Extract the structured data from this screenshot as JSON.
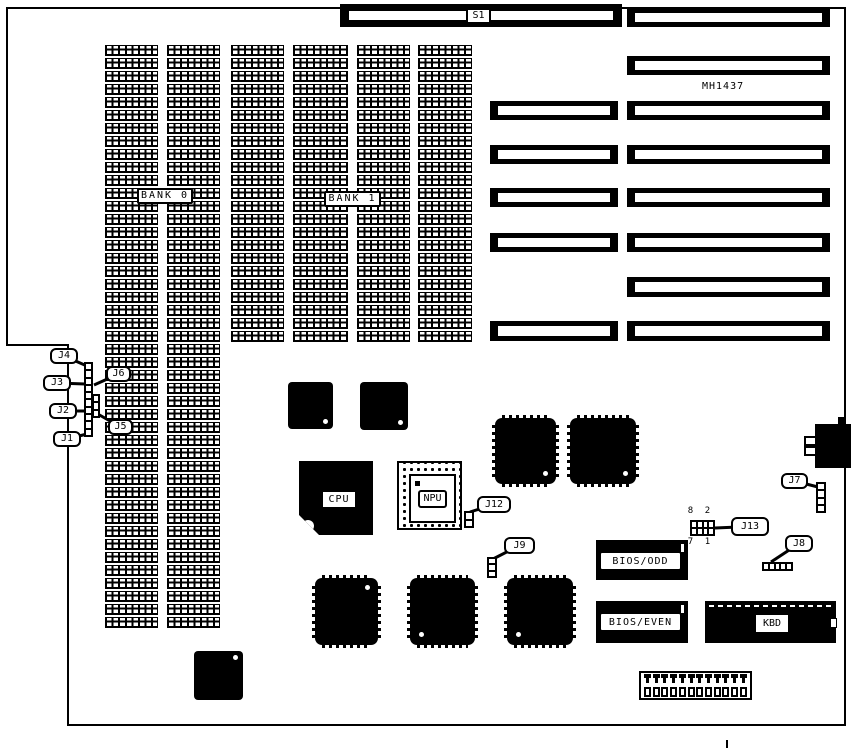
{
  "board": {
    "part_number": "MH1437",
    "outline_path": "M 7 8 H 845 V 725 H 68 V 345 H 7 Z",
    "ink_color": "#000000",
    "background_color": "#ffffff"
  },
  "labels": {
    "s1": "S1",
    "mh": "MH1437"
  },
  "j13_pins": {
    "tl": "8",
    "tr": "2",
    "bl": "7",
    "br": "1"
  },
  "slots": [
    {
      "x": 490,
      "y": 101,
      "w": 128,
      "h": 19
    },
    {
      "x": 490,
      "y": 145,
      "w": 128,
      "h": 19
    },
    {
      "x": 490,
      "y": 188,
      "w": 128,
      "h": 19
    },
    {
      "x": 490,
      "y": 233,
      "w": 128,
      "h": 19
    },
    {
      "x": 490,
      "y": 321,
      "w": 128,
      "h": 20
    },
    {
      "x": 627,
      "y": 8,
      "w": 203,
      "h": 19
    },
    {
      "x": 627,
      "y": 56,
      "w": 203,
      "h": 19
    },
    {
      "x": 627,
      "y": 101,
      "w": 203,
      "h": 19
    },
    {
      "x": 627,
      "y": 145,
      "w": 203,
      "h": 19
    },
    {
      "x": 627,
      "y": 188,
      "w": 203,
      "h": 19
    },
    {
      "x": 627,
      "y": 233,
      "w": 203,
      "h": 19
    },
    {
      "x": 627,
      "y": 277,
      "w": 203,
      "h": 20
    },
    {
      "x": 627,
      "y": 321,
      "w": 203,
      "h": 20
    }
  ],
  "memory": {
    "banks": [
      {
        "label": "BANK 0",
        "x": 137,
        "y": 188,
        "w": 56,
        "h": 16
      },
      {
        "label": "BANK 1",
        "x": 324,
        "y": 191,
        "w": 57,
        "h": 16
      }
    ],
    "columns": [
      {
        "x": 105,
        "y": 45,
        "w": 53,
        "chips": 45
      },
      {
        "x": 167,
        "y": 45,
        "w": 53,
        "chips": 45
      },
      {
        "x": 231,
        "y": 45,
        "w": 53,
        "chips": 23
      },
      {
        "x": 293,
        "y": 45,
        "w": 55,
        "chips": 23
      },
      {
        "x": 357,
        "y": 45,
        "w": 53,
        "chips": 23
      },
      {
        "x": 418,
        "y": 45,
        "w": 54,
        "chips": 23
      }
    ]
  },
  "chips": [
    {
      "name": "square-chip-1",
      "style": "plain",
      "x": 288,
      "y": 382,
      "w": 45,
      "h": 47,
      "dot": "br"
    },
    {
      "name": "square-chip-2",
      "style": "plain",
      "x": 360,
      "y": 382,
      "w": 48,
      "h": 48,
      "dot": "br"
    },
    {
      "name": "cpu",
      "style": "cpu",
      "x": 299,
      "y": 461,
      "w": 74,
      "h": 74,
      "label": "CPU"
    },
    {
      "name": "npu",
      "style": "pga",
      "x": 397,
      "y": 461,
      "w": 65,
      "h": 69,
      "label": "NPU"
    },
    {
      "name": "qfp-chip-1",
      "style": "qfp",
      "x": 495,
      "y": 418,
      "w": 61,
      "h": 66,
      "dot": "br"
    },
    {
      "name": "qfp-chip-2",
      "style": "qfp",
      "x": 570,
      "y": 418,
      "w": 66,
      "h": 66,
      "dot": "br"
    },
    {
      "name": "qfp-chip-3",
      "style": "qfp",
      "x": 315,
      "y": 578,
      "w": 63,
      "h": 67,
      "dot": "tr"
    },
    {
      "name": "qfp-chip-4",
      "style": "qfp",
      "x": 410,
      "y": 578,
      "w": 65,
      "h": 67,
      "dot": "bl"
    },
    {
      "name": "qfp-chip-5",
      "style": "qfp",
      "x": 507,
      "y": 578,
      "w": 66,
      "h": 67,
      "dot": "bl"
    },
    {
      "name": "square-chip-3",
      "style": "plain",
      "x": 194,
      "y": 651,
      "w": 49,
      "h": 49,
      "dot": "tr"
    },
    {
      "name": "bios-odd-rom",
      "style": "rom",
      "x": 596,
      "y": 540,
      "w": 92,
      "h": 40,
      "label": "BIOS/ODD"
    },
    {
      "name": "bios-even-rom",
      "style": "rom",
      "x": 596,
      "y": 601,
      "w": 92,
      "h": 42,
      "label": "BIOS/EVEN"
    },
    {
      "name": "kbd-controller",
      "style": "kbd",
      "x": 705,
      "y": 601,
      "w": 131,
      "h": 42,
      "label": "KBD"
    }
  ],
  "jumpers": [
    {
      "name": "jumper-block-left",
      "x": 84,
      "y": 362,
      "w": 9,
      "h": 75,
      "dir": "v",
      "cells": 10
    },
    {
      "name": "jumper-block-left-side",
      "x": 92,
      "y": 394,
      "w": 8,
      "h": 24,
      "dir": "v",
      "cells": 3
    },
    {
      "name": "jumper-j12",
      "x": 464,
      "y": 511,
      "w": 10,
      "h": 17,
      "dir": "v",
      "cells": 2
    },
    {
      "name": "jumper-j9",
      "x": 487,
      "y": 557,
      "w": 10,
      "h": 21,
      "dir": "v",
      "cells": 3
    },
    {
      "name": "jumper-j7",
      "x": 816,
      "y": 482,
      "w": 10,
      "h": 31,
      "dir": "v",
      "cells": 4
    },
    {
      "name": "jumper-j8",
      "x": 762,
      "y": 562,
      "w": 31,
      "h": 9,
      "dir": "h",
      "cells": 5
    }
  ],
  "callouts": [
    {
      "label": "J4",
      "x": 50,
      "y": 348,
      "w": 28,
      "h": 16,
      "tx": 87,
      "ty": 366
    },
    {
      "label": "J3",
      "x": 43,
      "y": 375,
      "w": 28,
      "h": 16,
      "tx": 85,
      "ty": 384
    },
    {
      "label": "J2",
      "x": 49,
      "y": 403,
      "w": 28,
      "h": 16,
      "tx": 85,
      "ty": 411
    },
    {
      "label": "J1",
      "x": 53,
      "y": 431,
      "w": 28,
      "h": 16,
      "tx": 87,
      "ty": 434
    },
    {
      "label": "J6",
      "x": 106,
      "y": 366,
      "w": 25,
      "h": 16,
      "tx": 94,
      "ty": 385
    },
    {
      "label": "J5",
      "x": 108,
      "y": 419,
      "w": 25,
      "h": 16,
      "tx": 96,
      "ty": 413
    },
    {
      "label": "J12",
      "x": 477,
      "y": 496,
      "w": 34,
      "h": 17,
      "tx": 470,
      "ty": 512
    },
    {
      "label": "J9",
      "x": 504,
      "y": 537,
      "w": 31,
      "h": 17,
      "tx": 493,
      "ty": 559
    },
    {
      "label": "J13",
      "x": 731,
      "y": 517,
      "w": 38,
      "h": 19,
      "tx": 715,
      "ty": 528
    },
    {
      "label": "J8",
      "x": 785,
      "y": 535,
      "w": 28,
      "h": 17,
      "tx": 771,
      "ty": 562
    },
    {
      "label": "J7",
      "x": 781,
      "y": 473,
      "w": 27,
      "h": 16,
      "tx": 818,
      "ty": 487
    }
  ],
  "bottom_connector": {
    "pins": 12
  }
}
